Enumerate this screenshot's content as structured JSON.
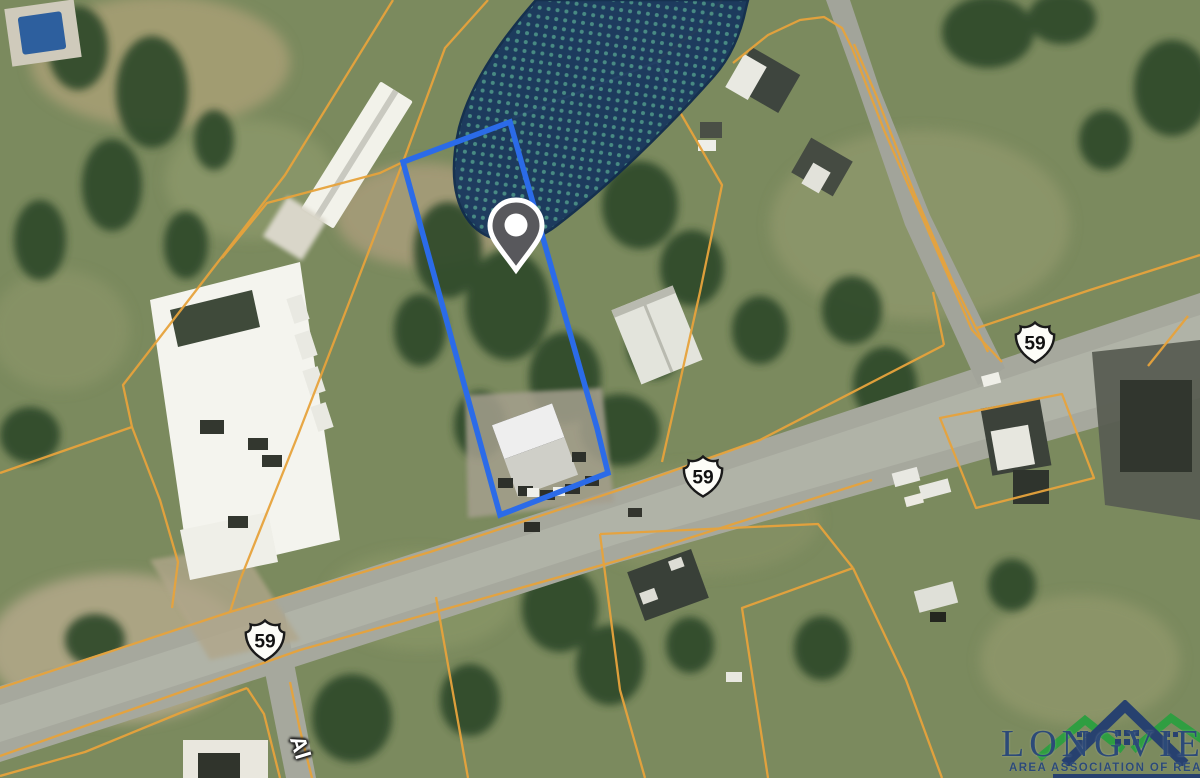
{
  "map": {
    "description": "aerial parcel map with flood zone overlay and highlighted subject lot",
    "route_shields": [
      {
        "label": "59"
      },
      {
        "label": "59"
      },
      {
        "label": "59"
      }
    ],
    "street_label": "Al",
    "colors": {
      "subject_parcel_outline": "#2b6be8",
      "parcel_boundary_lines": "#e7a33c",
      "flood_zone_fill": "#16355e",
      "flood_zone_dots": "#4d9a8e",
      "location_pin": "#58585c",
      "road_surface": "#a6a89d"
    }
  },
  "watermark": {
    "brand": "LONGVIEW",
    "tagline": "AREA ASSOCIATION OF REALTORS®",
    "navy": "#27416f",
    "green": "#2f9e41"
  }
}
